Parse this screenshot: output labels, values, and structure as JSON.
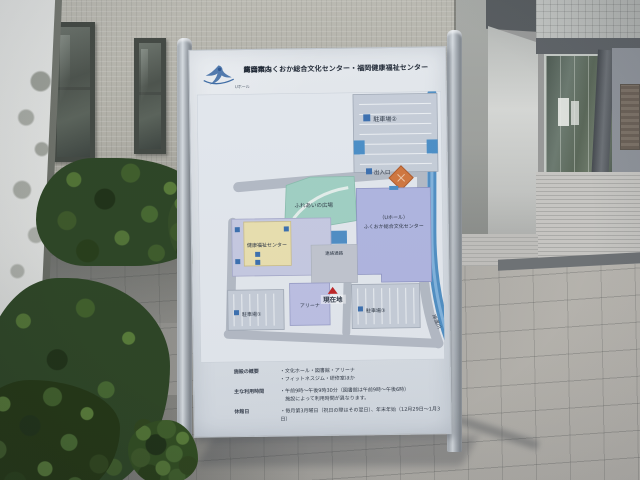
{
  "sign": {
    "logo": {
      "icon": "bird-logo-icon",
      "text": "Uホール"
    },
    "title_line1": "高岡市ふくおか総合文化センター・福岡健康福祉センター",
    "title_line2": "総合案内",
    "map": {
      "parking1_label": "駐車場①",
      "parking2_label": "駐車場②",
      "parking3_label": "駐車場③",
      "entrance_label": "出入口",
      "plaza_label": "ふれあいの広場",
      "main_building_line1": "（Uホール）",
      "main_building_line2": "ふくおか総合文化センター",
      "health_center_label": "健康福祉センター",
      "arena_label": "アリーナ",
      "corridor_label": "連絡通路",
      "river_label": "岸渡川",
      "you_are_here_label": "現在地"
    },
    "info_rows": [
      {
        "label": "施設の概要",
        "value": "・文化ホール・図書館・アリーナ\n・フィットネスジム・研修室ほか"
      },
      {
        "label": "主な利用時間",
        "value": "・午前9時〜午後9時30分（図書館は午前9時〜午後6時）\n　施設によって利用時間が異なります。"
      },
      {
        "label": "休館日",
        "value": "・毎月第3月曜日（祝日の際はその翌日）、年末年始（12月29日〜1月3日）"
      }
    ]
  },
  "colors": {
    "panel": "#e4e8ec",
    "river": "#4f8fc4",
    "main_building": "#b2b7e2",
    "plaza": "#a2d3c4",
    "health_center": "#eee3b0",
    "diamond_monument": "#d4763b",
    "you_are_here": "#c22222",
    "title_text": "#1c2430"
  }
}
